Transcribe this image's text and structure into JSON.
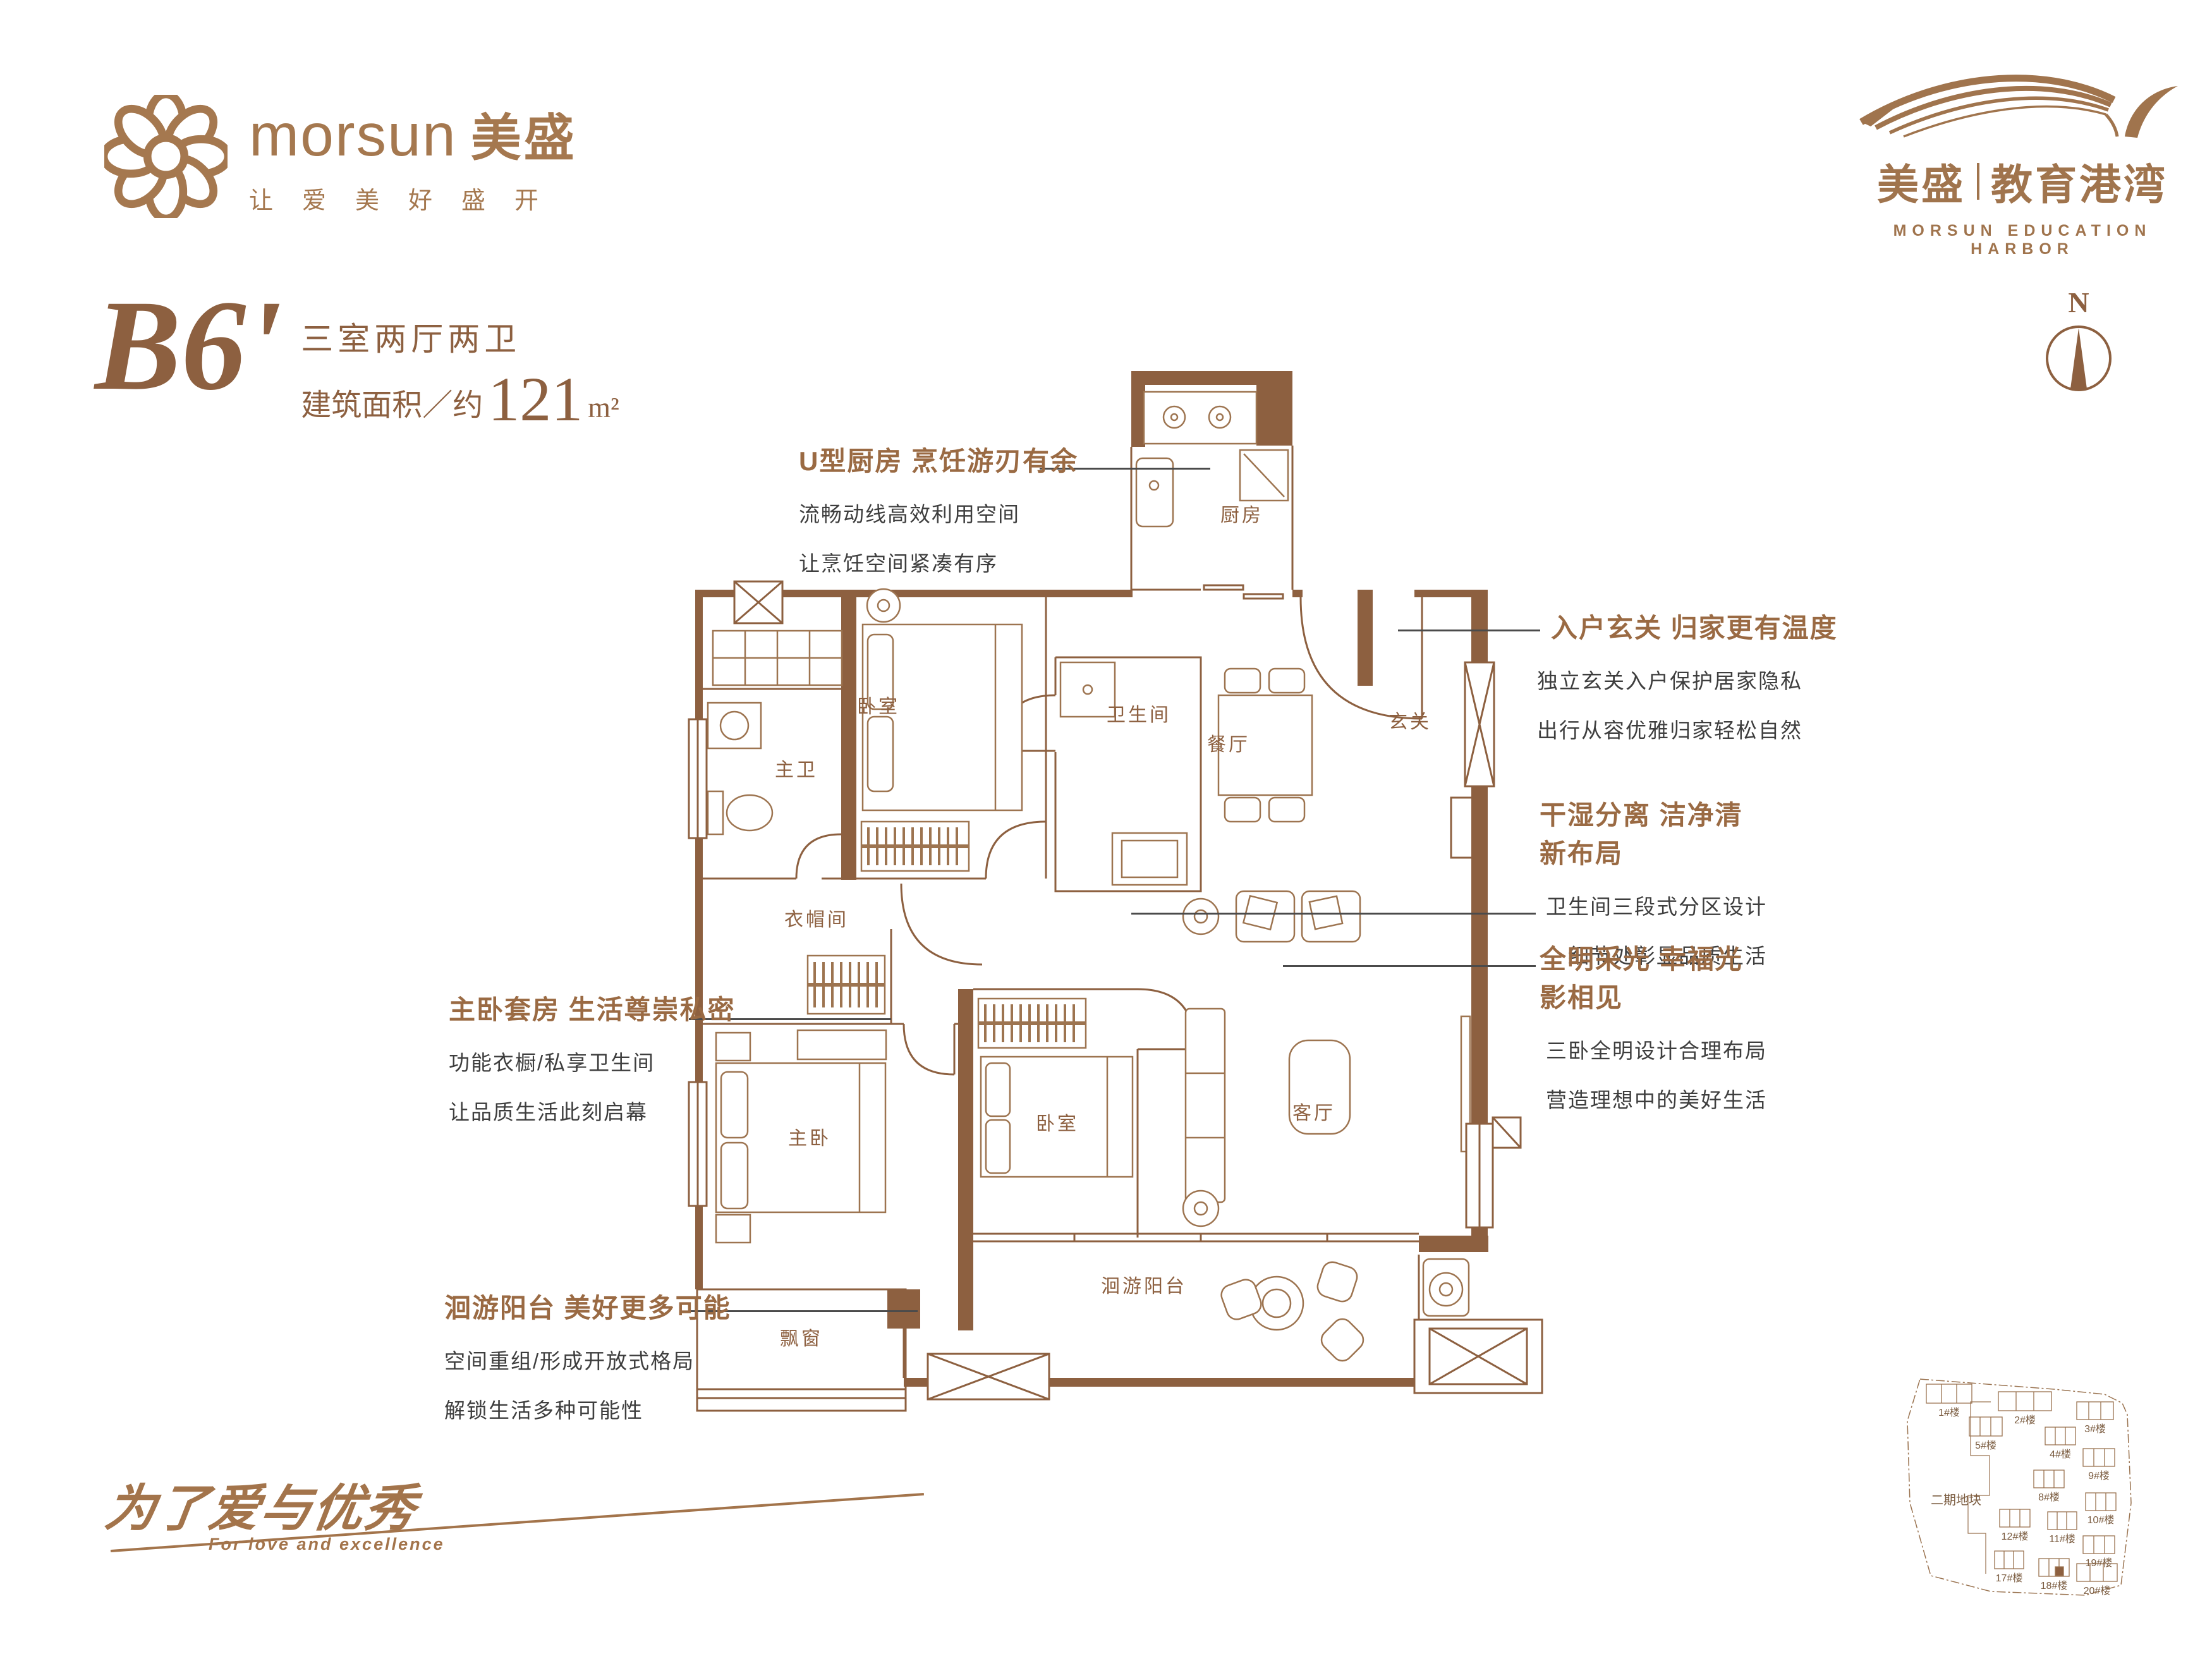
{
  "colors": {
    "brand": "#a5784f",
    "plan": "#8d6040",
    "heading": "#9a6a43",
    "body_text": "#3e3e3e"
  },
  "brand_left": {
    "name": "morsun",
    "cn": "美盛",
    "tagline": "让爱美好盛开"
  },
  "brand_right": {
    "cn1": "美盛",
    "cn2": "教育港湾",
    "en": "MORSUN EDUCATION HARBOR"
  },
  "unit": {
    "code": "B6'",
    "layout": "三室两厅两卫",
    "area_prefix": "建筑面积／约",
    "area_value": "121",
    "area_unit": "m²"
  },
  "compass": {
    "north": "N"
  },
  "callouts": [
    {
      "title": "U型厨房 烹饪游刃有余",
      "line1": "流畅动线高效利用空间",
      "line2": "让烹饪空间紧凑有序"
    },
    {
      "title": "入户玄关 归家更有温度",
      "line1": "独立玄关入户保护居家隐私",
      "line2": "出行从容优雅归家轻松自然"
    },
    {
      "title": "干湿分离 洁净清新布局",
      "line1": "卫生间三段式分区设计",
      "line2": "细节处彰显品质生活"
    },
    {
      "title": "全明采光 幸福光影相见",
      "line1": "三卧全明设计合理布局",
      "line2": "营造理想中的美好生活"
    },
    {
      "title": "主卧套房 生活尊崇私密",
      "line1": "功能衣橱/私享卫生间",
      "line2": "让品质生活此刻启幕"
    },
    {
      "title": "洄游阳台 美好更多可能",
      "line1": "空间重组/形成开放式格局",
      "line2": "解锁生活多种可能性"
    }
  ],
  "rooms": [
    {
      "label": "厨房"
    },
    {
      "label": "玄关"
    },
    {
      "label": "餐厅"
    },
    {
      "label": "卫生间"
    },
    {
      "label": "卧室"
    },
    {
      "label": "主卫"
    },
    {
      "label": "衣帽间"
    },
    {
      "label": "主卧"
    },
    {
      "label": "卧室"
    },
    {
      "label": "客厅"
    },
    {
      "label": "洄游阳台"
    },
    {
      "label": "飘窗"
    }
  ],
  "slogan": {
    "cn": "为了爱与优秀",
    "en": "For love and excellence"
  },
  "siteplan": {
    "phase": "二期地块",
    "buildings": [
      {
        "label": "1#楼"
      },
      {
        "label": "2#楼"
      },
      {
        "label": "3#楼"
      },
      {
        "label": "4#楼"
      },
      {
        "label": "5#楼"
      },
      {
        "label": "8#楼"
      },
      {
        "label": "9#楼"
      },
      {
        "label": "10#楼"
      },
      {
        "label": "11#楼"
      },
      {
        "label": "12#楼"
      },
      {
        "label": "17#楼"
      },
      {
        "label": "18#楼"
      },
      {
        "label": "19#楼"
      },
      {
        "label": "20#楼"
      }
    ]
  }
}
